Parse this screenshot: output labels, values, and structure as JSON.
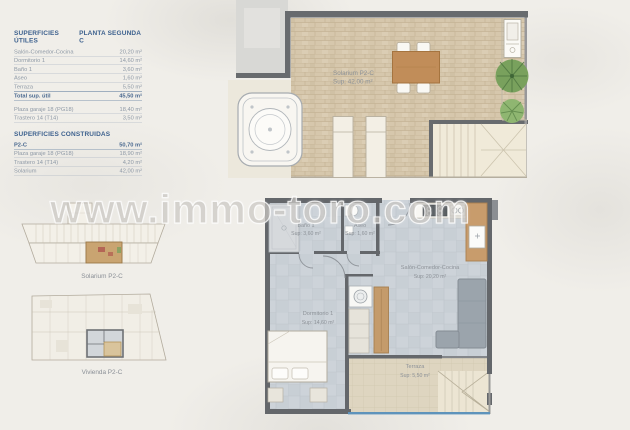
{
  "watermark": "www.immo-toro.com",
  "surfaces_utiles": {
    "title": "SUPERFICIES ÚTILES",
    "plan_title": "PLANTA SEGUNDA C",
    "rows": [
      {
        "label": "Salón-Comedor-Cocina",
        "value": "20,20 m²"
      },
      {
        "label": "Dormitorio 1",
        "value": "14,60 m²"
      },
      {
        "label": "Baño 1",
        "value": "3,60 m²"
      },
      {
        "label": "Aseo",
        "value": "1,60 m²"
      },
      {
        "label": "Terraza",
        "value": "5,50 m²"
      }
    ],
    "total": {
      "label": "Total sup. útil",
      "value": "45,50 m²"
    },
    "annex_rows": [
      {
        "label": "Plaza garaje 18 (PG18)",
        "value": "18,40 m²"
      },
      {
        "label": "Trastero 14 (T14)",
        "value": "3,50 m²"
      }
    ]
  },
  "surfaces_construidas": {
    "title": "SUPERFICIES CONSTRUIDAS",
    "rows": [
      {
        "label": "P2-C",
        "value": "50,70 m²"
      },
      {
        "label": "Plaza garaje 18 (PG18)",
        "value": "18,90 m²"
      },
      {
        "label": "Trastero 14 (T14)",
        "value": "4,20 m²"
      },
      {
        "label": "Solarium",
        "value": "42,00 m²"
      }
    ]
  },
  "key_plans": {
    "solarium_label": "Solarium P2-C",
    "vivienda_label": "Vivienda P2-C"
  },
  "solarium_plan": {
    "room_label": "Solarium P2-C",
    "room_area": "Sup: 42,00 m²"
  },
  "apartment_plan": {
    "rooms": [
      {
        "name": "Baño 1",
        "area": "Sup: 3,60 m²"
      },
      {
        "name": "Aseo",
        "area": "Sup: 1,60 m²"
      },
      {
        "name": "Salón-Comedor-Cocina",
        "area": "Sup: 20,20 m²"
      },
      {
        "name": "Dormitorio 1",
        "area": "Sup: 14,60 m²"
      },
      {
        "name": "Terraza",
        "area": "Sup: 5,50 m²"
      }
    ]
  },
  "colors": {
    "accent_blue": "#3d618e",
    "wall_gray": "#64676b",
    "floor_tile": "#cdd3d9",
    "terrace_tan": "#d6c7ac",
    "railing_blue": "#5e93bb"
  }
}
